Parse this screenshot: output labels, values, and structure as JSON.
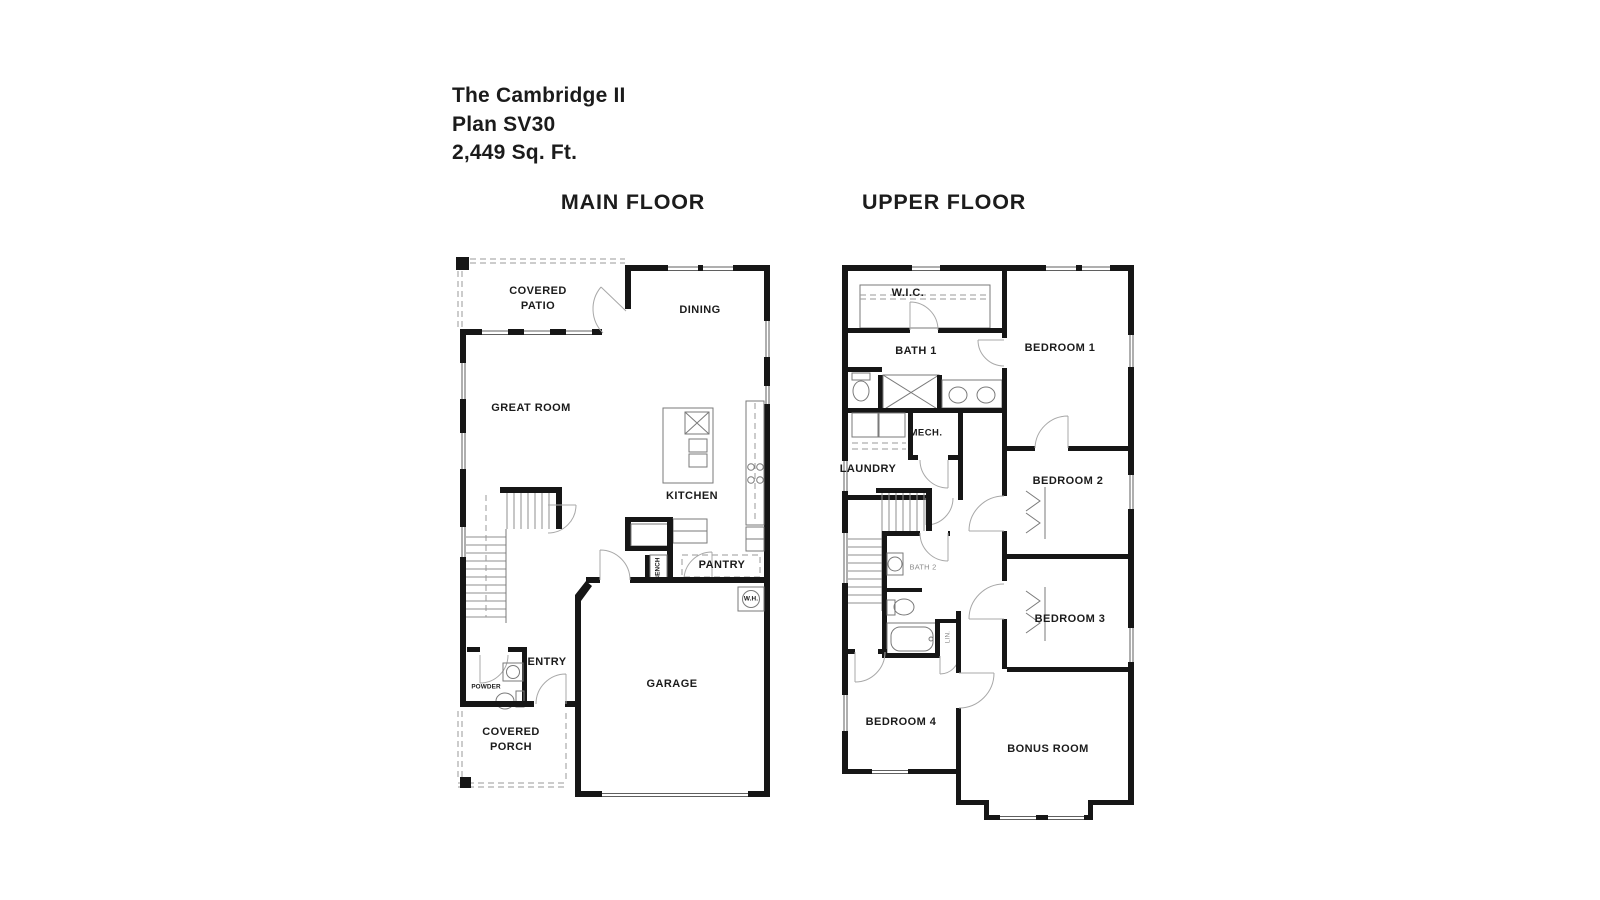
{
  "window": {
    "background": "#ffffff"
  },
  "colors": {
    "ink": "#1b1b1b",
    "wall": "#161616",
    "line": "#7a7a7a",
    "muted": "#8d8d8d",
    "background": "#ffffff"
  },
  "title_block": {
    "line1": "The Cambridge II",
    "line2": "Plan SV30",
    "line3": "2,449 Sq. Ft."
  },
  "floors": {
    "main": {
      "heading": "MAIN FLOOR",
      "rooms": {
        "covered_patio": {
          "line1": "COVERED",
          "line2": "PATIO"
        },
        "dining": "DINING",
        "great_room": "GREAT ROOM",
        "kitchen": "KITCHEN",
        "pantry": "PANTRY",
        "bench": "BENCH",
        "water_heater": "W.H.",
        "entry": "ENTRY",
        "powder": "POWDER",
        "garage": "GARAGE",
        "covered_porch": {
          "line1": "COVERED",
          "line2": "PORCH"
        }
      }
    },
    "upper": {
      "heading": "UPPER FLOOR",
      "rooms": {
        "wic": "W.I.C.",
        "bath1": "BATH 1",
        "bedroom1": "BEDROOM 1",
        "mech": "MECH.",
        "laundry": "LAUNDRY",
        "bedroom2": "BEDROOM 2",
        "bath2": "BATH 2",
        "linen": "LIN.",
        "bedroom3": "BEDROOM 3",
        "bedroom4": "BEDROOM 4",
        "bonus_room": "BONUS ROOM"
      }
    }
  }
}
